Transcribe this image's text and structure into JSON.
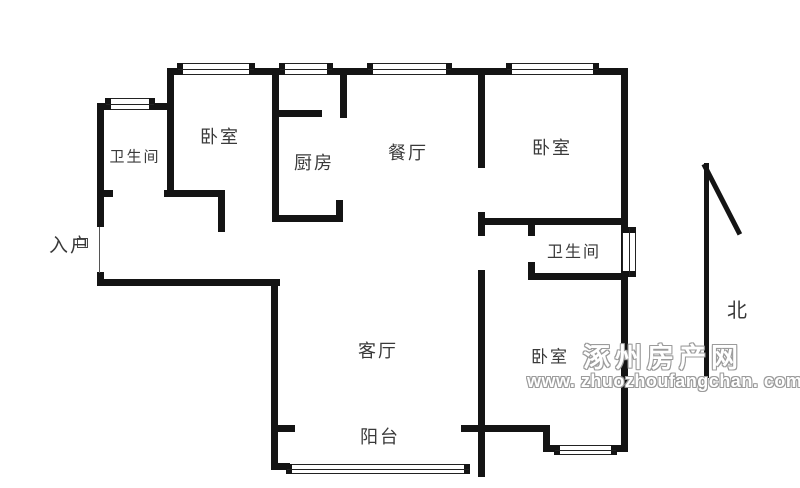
{
  "rooms": {
    "bathroom_top_left": "卫生间",
    "bedroom_top_left": "卧室",
    "kitchen": "厨房",
    "dining": "餐厅",
    "bedroom_top_right": "卧室",
    "entrance": "入户",
    "bathroom_right": "卫生间",
    "living": "客厅",
    "balcony": "阳台",
    "bedroom_bottom_right": "卧室"
  },
  "compass": {
    "north_label": "北"
  },
  "watermark": {
    "site_name": "涿州房产网",
    "site_url": "www. zhuozhoufangchan. com"
  },
  "colors": {
    "wall": "#141414",
    "label": "#3a3a3a",
    "watermark_outline": "#9b9b9b"
  }
}
